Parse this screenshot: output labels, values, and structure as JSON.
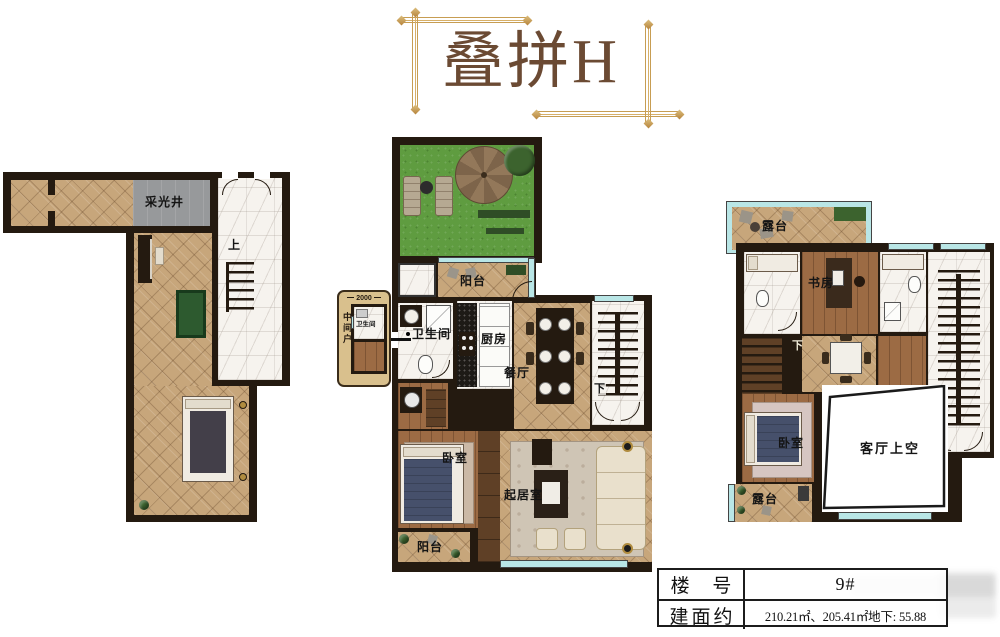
{
  "title": {
    "text": "叠拼H"
  },
  "info_table": {
    "rows": [
      {
        "label": "楼 号",
        "value": "9#"
      },
      {
        "label": "建面约",
        "value": "210.21㎡、205.41㎡地下: 55.88"
      }
    ]
  },
  "plans": {
    "basement": {
      "light_well": "采光井",
      "stairs_up": "上"
    },
    "middle": {
      "balcony_top": "阳台",
      "bathroom": "卫生间",
      "kitchen": "厨房",
      "dining": "餐厅",
      "stairs_down": "下",
      "bedroom": "卧室",
      "living": "起居室",
      "balcony_bottom": "阳台",
      "inset_unit": "中间户",
      "inset_dimension": "2000",
      "inset_bathroom": "卫生间"
    },
    "upper": {
      "terrace_top": "露台",
      "study": "书房",
      "stairs_down": "下",
      "bedroom": "卧室",
      "living_void": "客厅上空",
      "terrace_bottom": "露台"
    }
  },
  "colors": {
    "wall": "#241a10",
    "floor_tile": "#c7a67b",
    "marble": "#f6f3ee",
    "wood": "#9c6b44",
    "garden_green": "#5f9c40",
    "window_glass": "#b9e6e6",
    "gold_frame": "#c79d52",
    "title_brown": "#6b4a33",
    "billiard_green": "#2d5a2f",
    "light_well_gray": "#97999b",
    "bed_blue": "#46506b"
  }
}
